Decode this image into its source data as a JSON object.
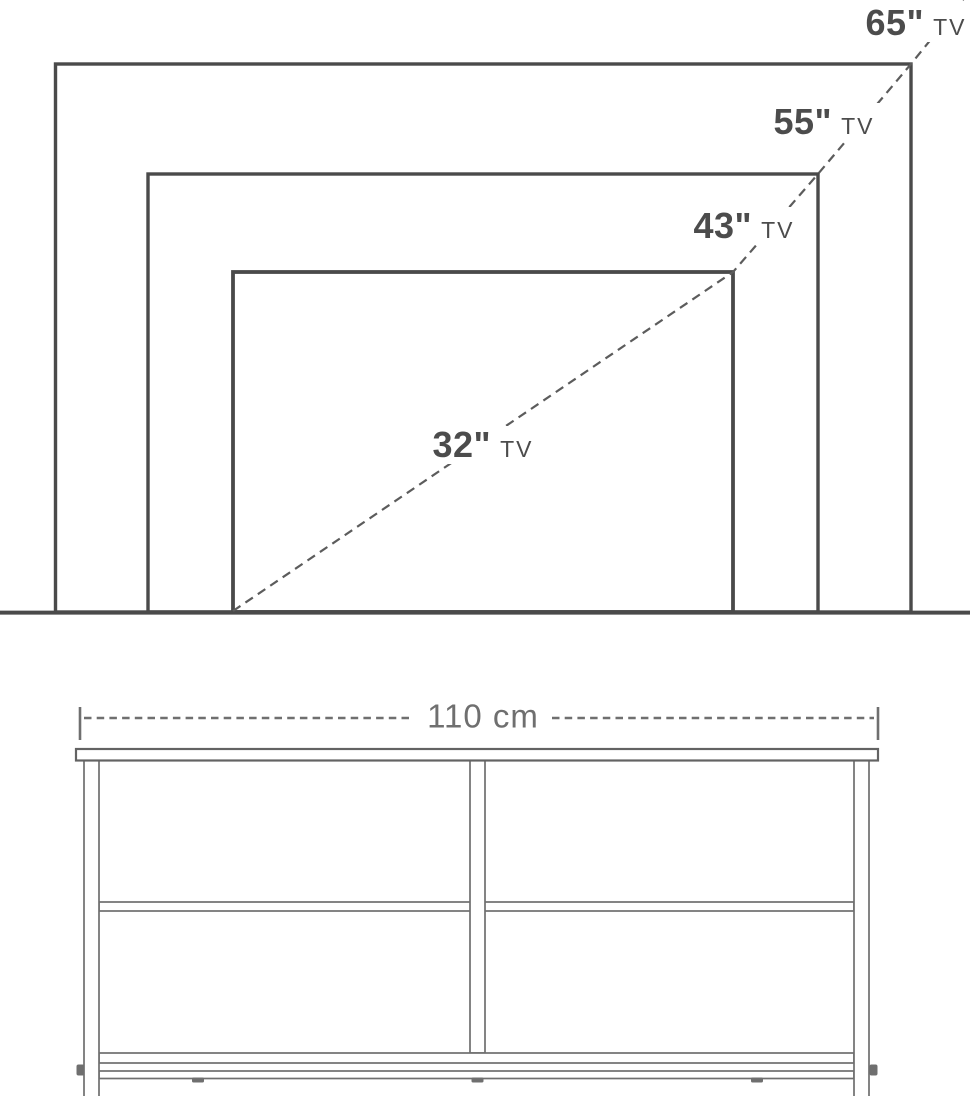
{
  "tv_size_chart": {
    "labels": [
      {
        "size": "65\"",
        "unit": "TV"
      },
      {
        "size": "55\"",
        "unit": "TV"
      },
      {
        "size": "43\"",
        "unit": "TV"
      },
      {
        "size": "32\"",
        "unit": "TV"
      }
    ]
  },
  "dimension": {
    "width_label": "110 cm"
  },
  "colors": {
    "background": "#ffffff",
    "outline_dark": "#4a4a4a",
    "diagonal_dash": "#5c5c5c",
    "stand_line": "#6f6f6f",
    "label_text_dark": "#4c4c4c",
    "dimension_text": "#6f6f6f"
  }
}
